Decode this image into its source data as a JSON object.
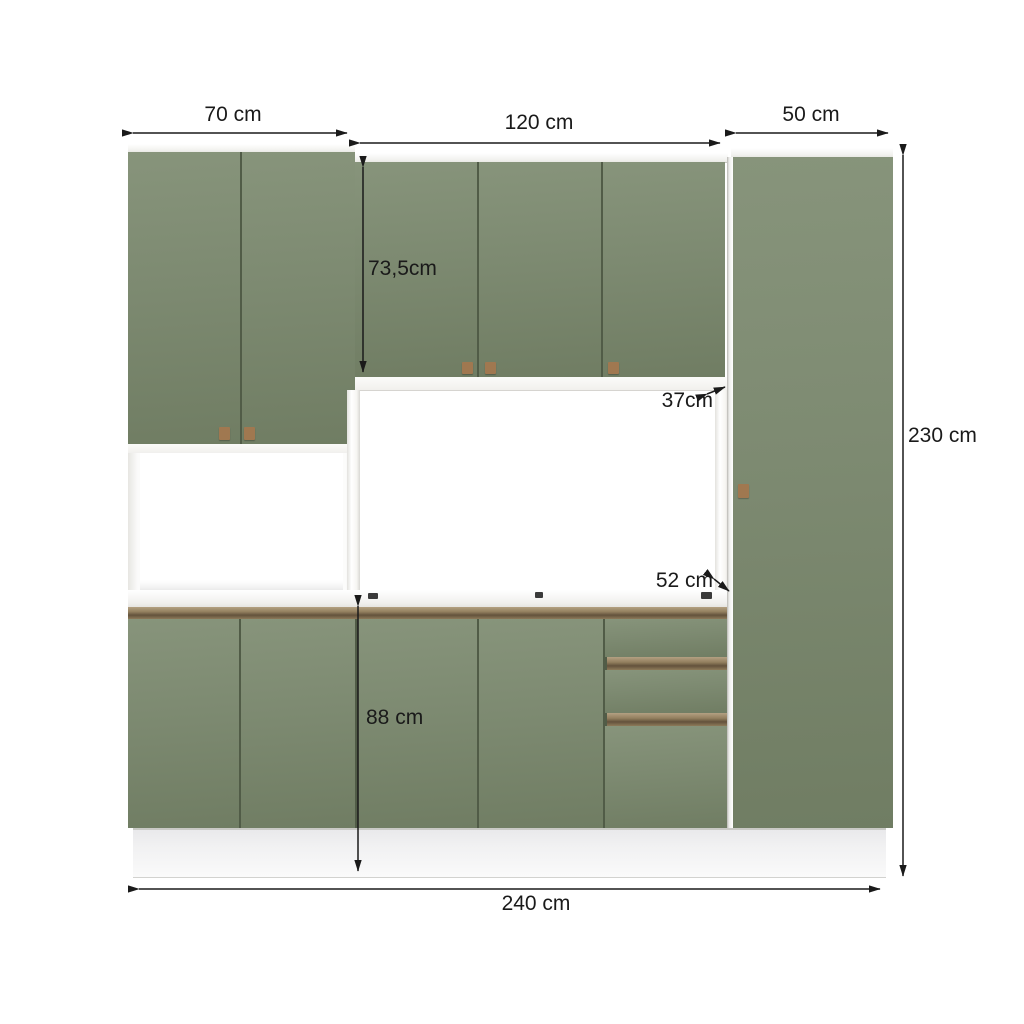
{
  "diagram_title": "Modular kitchen cabinet dimensions",
  "labels": {
    "left_section_width": "70 cm",
    "middle_section_width": "120 cm",
    "right_section_width": "50 cm",
    "wall_cabinet_height": "73,5cm",
    "wall_cabinet_depth": "37cm",
    "countertop_depth": "52 cm",
    "base_cabinet_height": "88 cm",
    "total_height": "230 cm",
    "total_width": "240 cm"
  },
  "colors": {
    "background": "#ffffff",
    "door_green": "#7d8a71",
    "gap_green": "#515c47",
    "handle_square_brown": "#a07850",
    "handle_rail_brown": "#93805f",
    "panel_white": "#f7f6f4",
    "dimension_line": "#1a1a1a"
  }
}
